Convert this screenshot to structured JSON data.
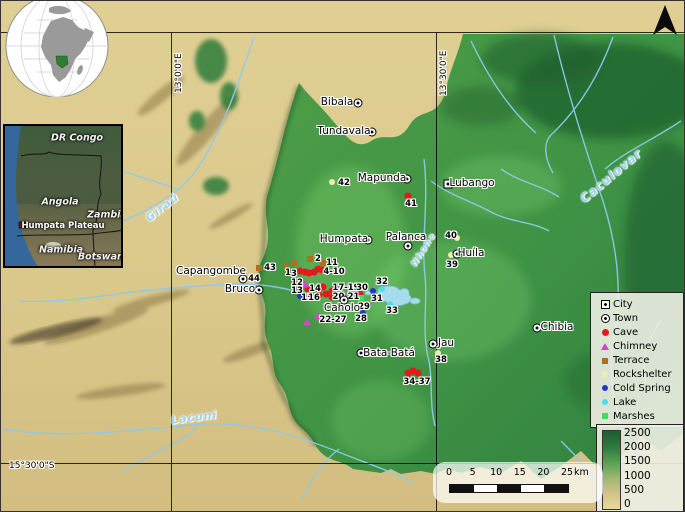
{
  "coords": {
    "west": "13°0'0\"E",
    "east": "13°30'0\"E",
    "south": "15°30'0\"S"
  },
  "insets": {
    "globe": {
      "highlight": "Angola"
    },
    "country_map": {
      "labels": [
        {
          "text": "DR Congo",
          "x": 72,
          "y": 12,
          "cls": "c-label"
        },
        {
          "text": "Angola",
          "x": 55,
          "y": 76,
          "cls": "c-label"
        },
        {
          "text": "Zambia",
          "x": 102,
          "y": 89,
          "cls": "c-label"
        },
        {
          "text": "Humpata Plateau",
          "x": 58,
          "y": 100,
          "cls": "c-small"
        },
        {
          "text": "Namibia",
          "x": 56,
          "y": 124,
          "cls": "c-label"
        },
        {
          "text": "Botswana",
          "x": 99,
          "y": 131,
          "cls": "c-label"
        }
      ]
    }
  },
  "rivers": [
    {
      "name": "Giraú",
      "x": 142,
      "y": 200,
      "angle": -38,
      "size": 11
    },
    {
      "name": "Caculovar",
      "x": 572,
      "y": 168,
      "angle": -40,
      "size": 12
    },
    {
      "name": "Nhone",
      "x": 404,
      "y": 244,
      "angle": -58,
      "size": 9
    },
    {
      "name": "Lacuni",
      "x": 170,
      "y": 410,
      "angle": -7,
      "size": 11
    }
  ],
  "settlements": [
    {
      "name": "Bibala",
      "type": "town",
      "mx": 357,
      "my": 102,
      "lx": 336,
      "ly": 101
    },
    {
      "name": "Tundavala",
      "type": "town",
      "mx": 371,
      "my": 131,
      "lx": 343,
      "ly": 130
    },
    {
      "name": "Mapunda",
      "type": "town",
      "mx": 406,
      "my": 178,
      "lx": 381,
      "ly": 177
    },
    {
      "name": "Lubango",
      "type": "city",
      "mx": 447,
      "my": 183,
      "lx": 471,
      "ly": 182
    },
    {
      "name": "Humpata",
      "type": "town",
      "mx": 367,
      "my": 239,
      "lx": 343,
      "ly": 238
    },
    {
      "name": "Palanca",
      "type": "town",
      "mx": 407,
      "my": 245,
      "lx": 405,
      "ly": 236
    },
    {
      "name": "Huíla",
      "type": "town",
      "mx": 456,
      "my": 253,
      "lx": 470,
      "ly": 252
    },
    {
      "name": "Capangombe",
      "type": "town",
      "mx": 242,
      "my": 278,
      "lx": 210,
      "ly": 270
    },
    {
      "name": "Bruco",
      "type": "town",
      "mx": 258,
      "my": 289,
      "lx": 239,
      "ly": 288
    },
    {
      "name": "Caholo",
      "type": "town",
      "mx": 343,
      "my": 299,
      "lx": 341,
      "ly": 307
    },
    {
      "name": "Bata-Batá",
      "type": "town",
      "mx": 360,
      "my": 352,
      "lx": 388,
      "ly": 352
    },
    {
      "name": "Jau",
      "type": "town",
      "mx": 432,
      "my": 343,
      "lx": 445,
      "ly": 342
    },
    {
      "name": "Chibia",
      "type": "town",
      "mx": 536,
      "my": 327,
      "lx": 556,
      "ly": 326
    }
  ],
  "sites": [
    {
      "label": "1",
      "x": 287,
      "y": 272
    },
    {
      "label": "3",
      "x": 293,
      "y": 273
    },
    {
      "label": "2",
      "x": 317,
      "y": 258
    },
    {
      "label": "11",
      "x": 331,
      "y": 262
    },
    {
      "label": "4-10",
      "x": 333,
      "y": 271
    },
    {
      "label": "12",
      "x": 296,
      "y": 282
    },
    {
      "label": "13",
      "x": 296,
      "y": 290
    },
    {
      "label": "14",
      "x": 314,
      "y": 288
    },
    {
      "label": "15",
      "x": 306,
      "y": 297
    },
    {
      "label": "16",
      "x": 313,
      "y": 297
    },
    {
      "label": "17-19",
      "x": 345,
      "y": 287
    },
    {
      "label": "20,21",
      "x": 345,
      "y": 296
    },
    {
      "label": "22-27",
      "x": 332,
      "y": 319
    },
    {
      "label": "28",
      "x": 360,
      "y": 318
    },
    {
      "label": "29",
      "x": 363,
      "y": 306
    },
    {
      "label": "30",
      "x": 361,
      "y": 287
    },
    {
      "label": "31",
      "x": 376,
      "y": 298
    },
    {
      "label": "32",
      "x": 381,
      "y": 281
    },
    {
      "label": "33",
      "x": 391,
      "y": 310
    },
    {
      "label": "34-37",
      "x": 416,
      "y": 381
    },
    {
      "label": "38",
      "x": 440,
      "y": 359
    },
    {
      "label": "39",
      "x": 451,
      "y": 264
    },
    {
      "label": "40",
      "x": 450,
      "y": 235
    },
    {
      "label": "41",
      "x": 410,
      "y": 203
    },
    {
      "label": "42",
      "x": 343,
      "y": 182
    },
    {
      "label": "43",
      "x": 269,
      "y": 267
    },
    {
      "label": "44",
      "x": 253,
      "y": 278
    }
  ],
  "markers": {
    "cave": [
      [
        299,
        270
      ],
      [
        304,
        271
      ],
      [
        308,
        272
      ],
      [
        313,
        271
      ],
      [
        317,
        268
      ],
      [
        321,
        269
      ],
      [
        307,
        288
      ],
      [
        318,
        288
      ],
      [
        322,
        286
      ],
      [
        318,
        294
      ],
      [
        325,
        293
      ],
      [
        331,
        290
      ],
      [
        331,
        296
      ],
      [
        359,
        293
      ],
      [
        407,
        195
      ],
      [
        407,
        372
      ],
      [
        412,
        370
      ],
      [
        417,
        372
      ]
    ],
    "terrace": [
      [
        309,
        258
      ],
      [
        322,
        262
      ],
      [
        293,
        262
      ],
      [
        285,
        265
      ],
      [
        258,
        267
      ]
    ],
    "chimney": [
      [
        304,
        283
      ],
      [
        317,
        315
      ],
      [
        306,
        321
      ]
    ],
    "cold_spring": [
      [
        299,
        295
      ],
      [
        362,
        312
      ],
      [
        367,
        304
      ],
      [
        372,
        290
      ]
    ],
    "lake": [
      [
        381,
        288
      ],
      [
        389,
        303
      ]
    ],
    "marshes": [
      [
        360,
        297
      ]
    ],
    "rockshelter": [
      [
        331,
        181
      ],
      [
        450,
        254
      ],
      [
        456,
        237
      ],
      [
        437,
        352
      ]
    ]
  },
  "legend": {
    "items": [
      {
        "type": "city",
        "label": "City"
      },
      {
        "type": "town",
        "label": "Town"
      },
      {
        "type": "cave",
        "label": "Cave"
      },
      {
        "type": "chimney",
        "label": "Chimney"
      },
      {
        "type": "terrace",
        "label": "Terrace"
      },
      {
        "type": "rockshelter",
        "label": "Rockshelter"
      },
      {
        "type": "cold_spring",
        "label": "Cold Spring"
      },
      {
        "type": "lake",
        "label": "Lake"
      },
      {
        "type": "marshes",
        "label": "Marshes"
      }
    ]
  },
  "elevation": {
    "ticks": [
      "2500",
      "2000",
      "1500",
      "1000",
      "500",
      "0"
    ]
  },
  "scalebar": {
    "ticks": [
      "0",
      "5",
      "10",
      "15",
      "20",
      "25"
    ],
    "unit": "km"
  },
  "marker_colors": {
    "cave": "#e3191c",
    "chimney": "#d944ce",
    "terrace": "#b06e1e",
    "rockshelter": "#edf0ad",
    "cold_spring": "#2337cf",
    "lake": "#4adee8",
    "marshes": "#3bdf5b"
  }
}
